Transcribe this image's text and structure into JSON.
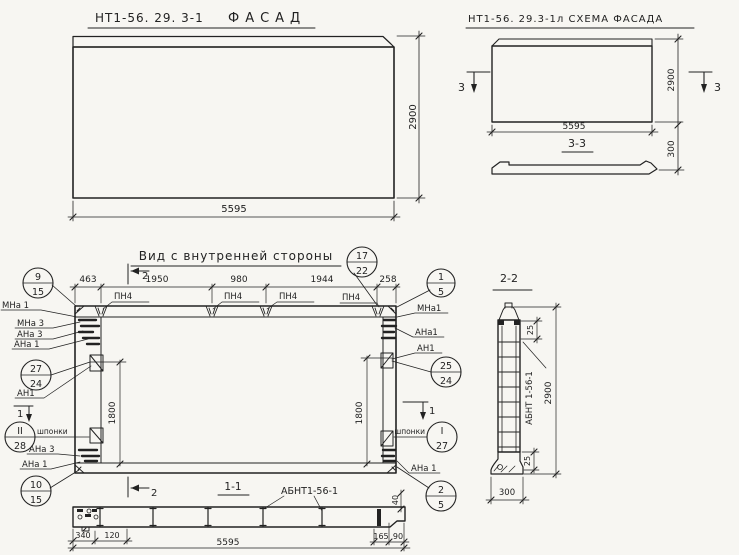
{
  "colors": {
    "paper": "#f7f6f2",
    "ink": "#222222"
  },
  "facade_view": {
    "code": "НТ1-56. 29. 3-1",
    "title": "ФАСАД",
    "dim_width": "5595",
    "dim_height": "2900"
  },
  "schema_view": {
    "title": "НТ1-56. 29.3-1л СХЕМА ФАСАДА",
    "dim_width": "5595",
    "dim_height": "2900",
    "marker_left": "3",
    "marker_right": "3",
    "section_title": "3-3",
    "dim_thickness": "300"
  },
  "inner_view": {
    "title": "Вид с внутренней стороны",
    "dims_top": [
      "463",
      "1950",
      "980",
      "1944",
      "258"
    ],
    "pn4": [
      "ПН4",
      "ПН4",
      "ПН4",
      "ПН4"
    ],
    "marker_2_top": "2",
    "marker_2_bottom": "2",
    "marker_1_left": "1",
    "marker_1_right": "1",
    "dim_left": "1800",
    "dim_right": "1800",
    "shponki_left": "шпонки",
    "shponki_right": "шпонки",
    "callouts": {
      "c9_15": {
        "top": "9",
        "bottom": "15"
      },
      "c27_24": {
        "top": "27",
        "bottom": "24"
      },
      "cII_28": {
        "top": "II",
        "bottom": "28"
      },
      "c10_15": {
        "top": "10",
        "bottom": "15"
      },
      "c17_22": {
        "top": "17",
        "bottom": "22"
      },
      "c1_5": {
        "top": "1",
        "bottom": "5"
      },
      "c25_24": {
        "top": "25",
        "bottom": "24"
      },
      "cI_27": {
        "top": "I",
        "bottom": "27"
      },
      "c2_5": {
        "top": "2",
        "bottom": "5"
      }
    },
    "labels_left": {
      "mna1": "МНа 1",
      "mna3": "МНа 3",
      "ana3": "АНа 3",
      "ana1": "АНа 1",
      "an1": "АН1",
      "ana3_b": "АНа 3",
      "ana1_b": "АНа 1"
    },
    "labels_right": {
      "mna1": "МНа1",
      "ana1": "АНа1",
      "an1": "АН1",
      "ana1_b": "АНа 1"
    }
  },
  "section_1_1": {
    "title": "1-1",
    "part": "АБНТ1-56-1",
    "dim_340": "340",
    "dim_120": "120",
    "dim_5595": "5595",
    "dim_40": "40",
    "dim_165": "165",
    "dim_90": "90"
  },
  "section_2_2": {
    "title": "2-2",
    "part": "АБНТ 1-56-1",
    "dim_25_top": "25",
    "dim_25_bottom": "25",
    "dim_2900": "2900",
    "dim_300": "300"
  }
}
